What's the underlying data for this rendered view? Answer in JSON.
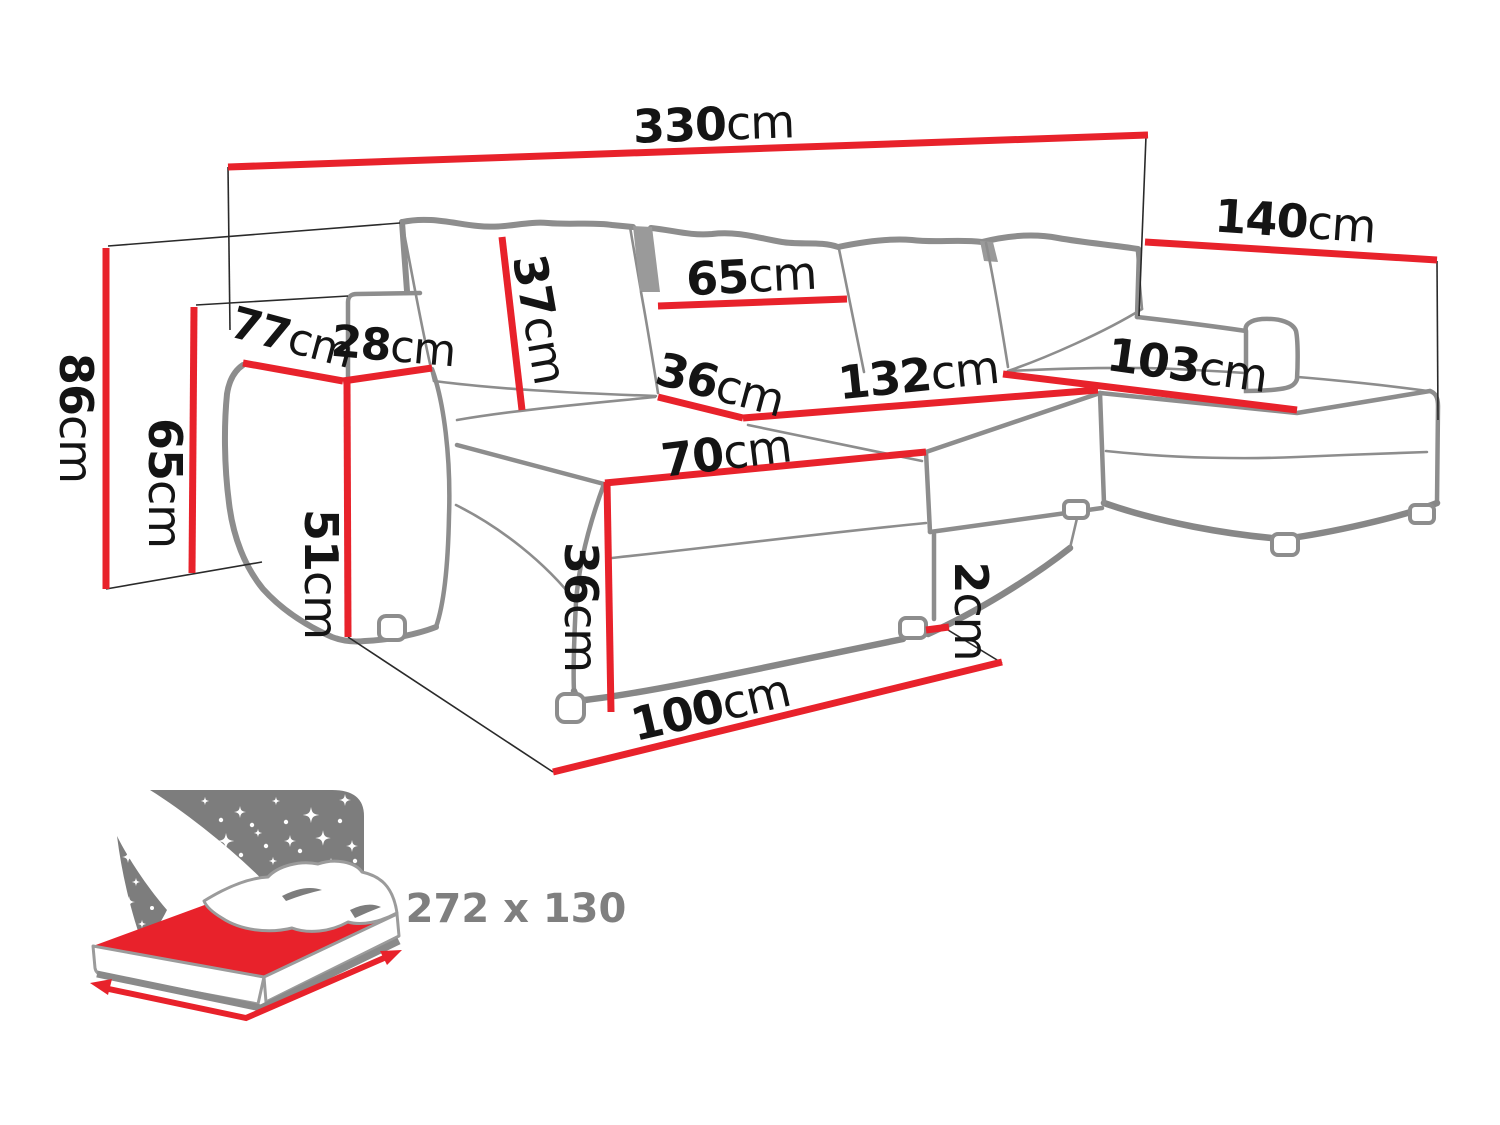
{
  "diagram": {
    "type": "furniture-dimension-diagram",
    "subject": "U-shaped corner sofa bed",
    "unit": "cm",
    "accent_color": "#e8222b",
    "outline_color": "#8d8d8d",
    "dimensions": {
      "total_width": {
        "value": "330",
        "unit": "cm"
      },
      "total_depth": {
        "value": "140",
        "unit": "cm"
      },
      "total_height": {
        "value": "86",
        "unit": "cm"
      },
      "backrest_height": {
        "value": "65",
        "unit": "cm"
      },
      "armrest_depth": {
        "value": "77",
        "unit": "cm"
      },
      "armrest_width": {
        "value": "28",
        "unit": "cm"
      },
      "back_cushion_height": {
        "value": "37",
        "unit": "cm"
      },
      "back_cushion_width": {
        "value": "65",
        "unit": "cm"
      },
      "seat_back_cushion": {
        "value": "36",
        "unit": "cm"
      },
      "seat_width": {
        "value": "132",
        "unit": "cm"
      },
      "right_chaise_width": {
        "value": "103",
        "unit": "cm"
      },
      "left_chaise_front": {
        "value": "70",
        "unit": "cm"
      },
      "armrest_height": {
        "value": "51",
        "unit": "cm"
      },
      "seat_front_height": {
        "value": "36",
        "unit": "cm"
      },
      "leg_height": {
        "value": "2",
        "unit": "cm"
      },
      "chaise_depth": {
        "value": "100",
        "unit": "cm"
      }
    },
    "sleeping_function": {
      "icon": "bed-with-night-sky-icon",
      "label": "272 x 130"
    }
  }
}
